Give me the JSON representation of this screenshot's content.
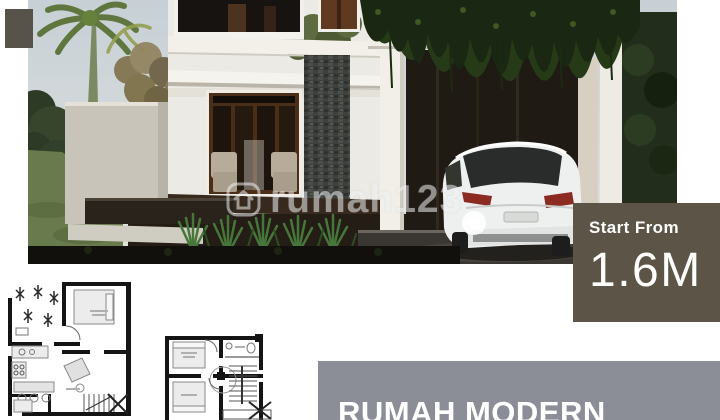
{
  "price_box": {
    "label": "Start From",
    "value": "1.6M",
    "bg_color": "#5c5547",
    "text_color": "#ffffff"
  },
  "banner": {
    "title": "RUMAH MODERN",
    "bg_color": "#8b8e96",
    "text_color": "#ffffff"
  },
  "watermark": {
    "text": "rumah123",
    "icon": "house-logo-icon"
  },
  "decor": {
    "corner_tag_color": "#57524a"
  },
  "photo_scene": {
    "subject": "two-story modern house rendering",
    "elements": [
      "palm-tree",
      "garden-wall",
      "glass-doors",
      "stone-accent-wall",
      "pergola-with-vines",
      "carport",
      "white-suv",
      "lawn",
      "spiky-plants"
    ],
    "car_color": "#eef0f0",
    "sky_color": "#c7d0d6"
  },
  "floorplans": {
    "count": 2,
    "style": "black-and-white architectural drawings"
  }
}
